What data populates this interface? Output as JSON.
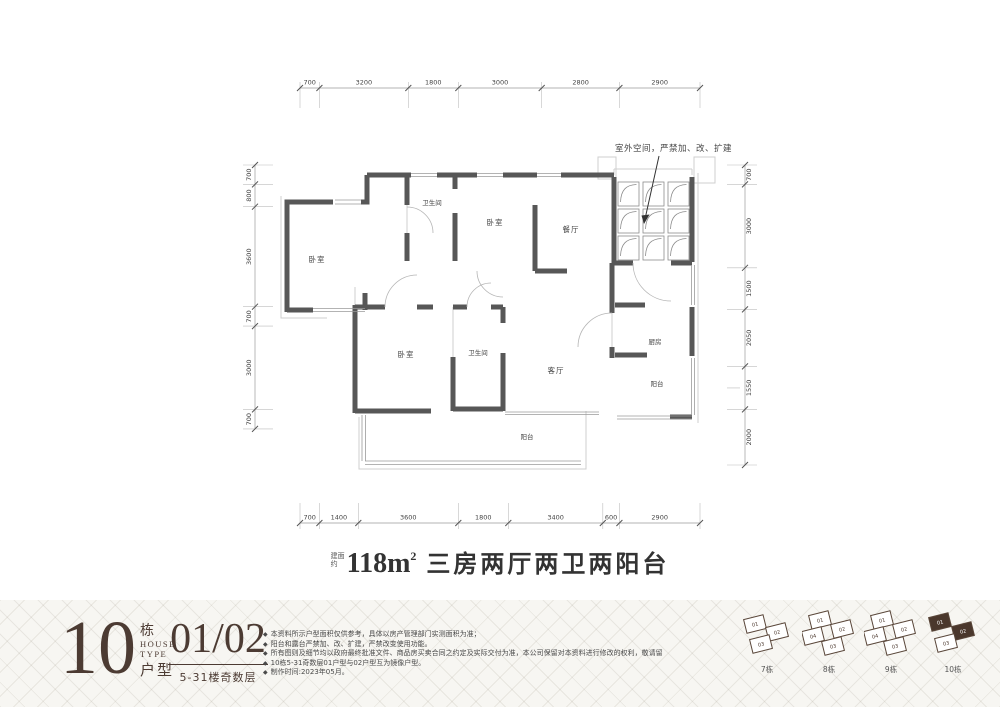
{
  "plan": {
    "dims_top": [
      "700",
      "3200",
      "1800",
      "3000",
      "2800",
      "2900"
    ],
    "dims_bottom": [
      "700",
      "1400",
      "3600",
      "1800",
      "3400",
      "600",
      "2900"
    ],
    "dims_left": [
      "700",
      "800",
      "3600",
      "700",
      "3000",
      "700"
    ],
    "dims_right": [
      "700",
      "3000",
      "1500",
      "2050",
      "1550",
      "2000"
    ],
    "rooms": {
      "bedroom1": "卧室",
      "bath1": "卫生间",
      "bedroom2": "卧室",
      "dining": "餐厅",
      "bedroom3": "卧室",
      "bath2": "卫生间",
      "living": "客厅",
      "kitchen": "厨房",
      "balcony_right": "阳台",
      "balcony_bottom": "阳台"
    },
    "annotation": "室外空间，严禁加、改、扩建"
  },
  "caption": {
    "prefix": "建面约",
    "area": "118m",
    "area_sup": "2",
    "description": "三房两厅两卫两阳台"
  },
  "footer": {
    "block_number": "10",
    "block_unit": "栋",
    "house_type_en_1": "HOUSE",
    "house_type_en_2": "TYPE",
    "house_type_cn": "户型",
    "unit_numbers": "01/02",
    "floors": "5-31楼奇数层",
    "disclaimers": [
      "本资料所示户型面积仅供参考，具体以房产管理部门实测面积为准；",
      "阳台和露台严禁加、改、扩建，严禁改变使用功能。",
      "所有图则及细节均以政府最终批准文件、商品房买卖合同之约定及实际交付为准，本公司保留对本资料进行修改的权利，敬请留意最新资料。",
      "10栋5-31奇数层01户型与02户型互为镜像户型。",
      "制作时间:2023年05月。"
    ],
    "buildings": [
      {
        "name": "7栋",
        "units": [
          {
            "label": "01",
            "highlighted": false
          },
          {
            "label": "02",
            "highlighted": false
          },
          {
            "label": "03",
            "highlighted": false
          }
        ]
      },
      {
        "name": "8栋",
        "units": [
          {
            "label": "01",
            "highlighted": false
          },
          {
            "label": "02",
            "highlighted": false
          },
          {
            "label": "04",
            "highlighted": false
          },
          {
            "label": "03",
            "highlighted": false
          }
        ]
      },
      {
        "name": "9栋",
        "units": [
          {
            "label": "01",
            "highlighted": false
          },
          {
            "label": "02",
            "highlighted": false
          },
          {
            "label": "04",
            "highlighted": false
          },
          {
            "label": "03",
            "highlighted": false
          }
        ]
      },
      {
        "name": "10栋",
        "units": [
          {
            "label": "01",
            "highlighted": true
          },
          {
            "label": "02",
            "highlighted": true
          },
          {
            "label": "03",
            "highlighted": false
          }
        ]
      }
    ]
  },
  "colors": {
    "wall": "#575757",
    "light_line": "#c9c9c9",
    "brand": "#4c3b33",
    "highlight": "#4a372c",
    "footer_bg": "#f7f6f2"
  }
}
